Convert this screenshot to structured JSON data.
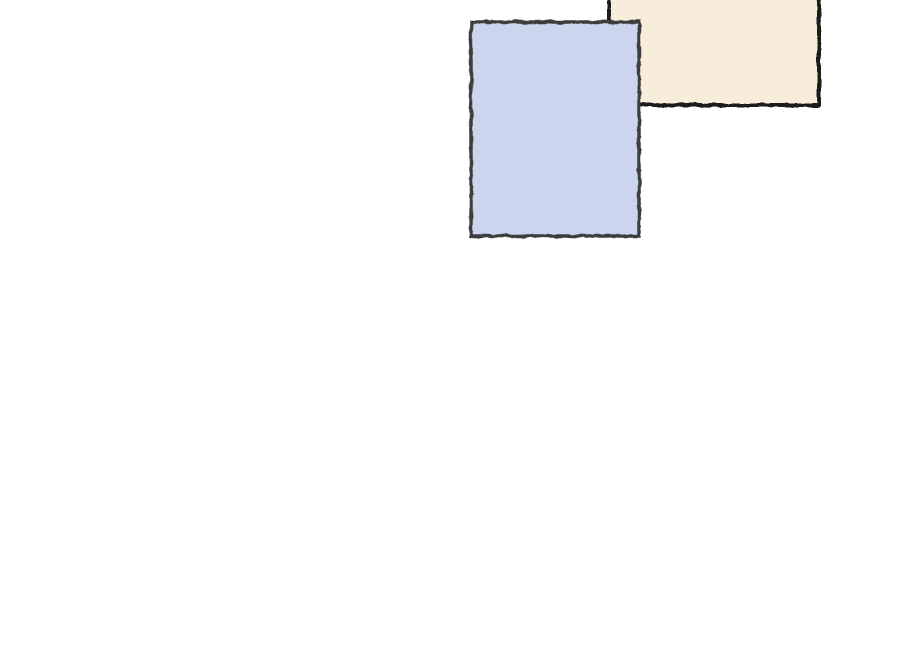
{
  "canvas": {
    "background": "#ffffff",
    "width": 900,
    "height": 655
  },
  "shapes": [
    {
      "id": "cream-rectangle",
      "type": "rect",
      "x": 609,
      "y": -40,
      "width": 210,
      "height": 145,
      "fill": "#f8edda",
      "stroke": "#1e1e1e",
      "stroke_width": 4
    },
    {
      "id": "blue-rectangle",
      "type": "rect",
      "x": 471,
      "y": 22,
      "width": 168,
      "height": 214,
      "fill": "#ccd5ee",
      "stroke": "#3d3d3d",
      "stroke_width": 3.5
    }
  ]
}
